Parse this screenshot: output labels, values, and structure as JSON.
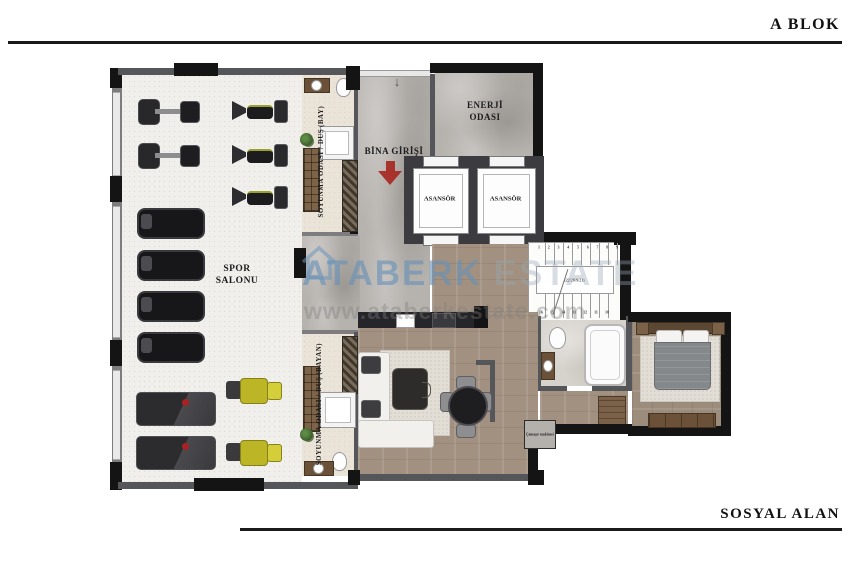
{
  "header": {
    "block_label": "A BLOK"
  },
  "footer": {
    "area_label": "SOSYAL ALAN"
  },
  "watermark": {
    "brand_primary": "ATABERK",
    "brand_secondary": "ESTATE",
    "website": "www.ataberkestate.com"
  },
  "rooms": {
    "gym": {
      "name_line1": "SPOR",
      "name_line2": "SALONU"
    },
    "locker_men": {
      "name": "SOYUNMA ODASI / DUŞ",
      "suffix": "(BAY)"
    },
    "locker_women": {
      "name": "SOYUNMA ODASI / DUŞ",
      "suffix": "(BAYAN)"
    },
    "entrance": {
      "name": "BİNA GİRİŞİ"
    },
    "energy": {
      "name_line1": "ENERJİ",
      "name_line2": "ODASI"
    },
    "elevators": {
      "left": "ASANSÖR",
      "right": "ASANSÖR"
    },
    "stairs": {
      "dimension_note": "(22/28/9/21)",
      "steps_top": [
        "1",
        "2",
        "3",
        "4",
        "5",
        "6",
        "7",
        "8",
        "9"
      ],
      "steps_bottom": [
        "16",
        "15",
        "14",
        "13",
        "12",
        "11",
        "10"
      ]
    },
    "laundry_label": "Çamaşır makinesi"
  },
  "colors": {
    "entrance_arrow": "#a8322c",
    "watermark_blue": "#6e96b9",
    "wall_dark": "#141414",
    "wall_gray": "#55565a",
    "wood": "#a29180",
    "marble": "#b6b2ae",
    "machine_yellow": "#bcb626"
  }
}
